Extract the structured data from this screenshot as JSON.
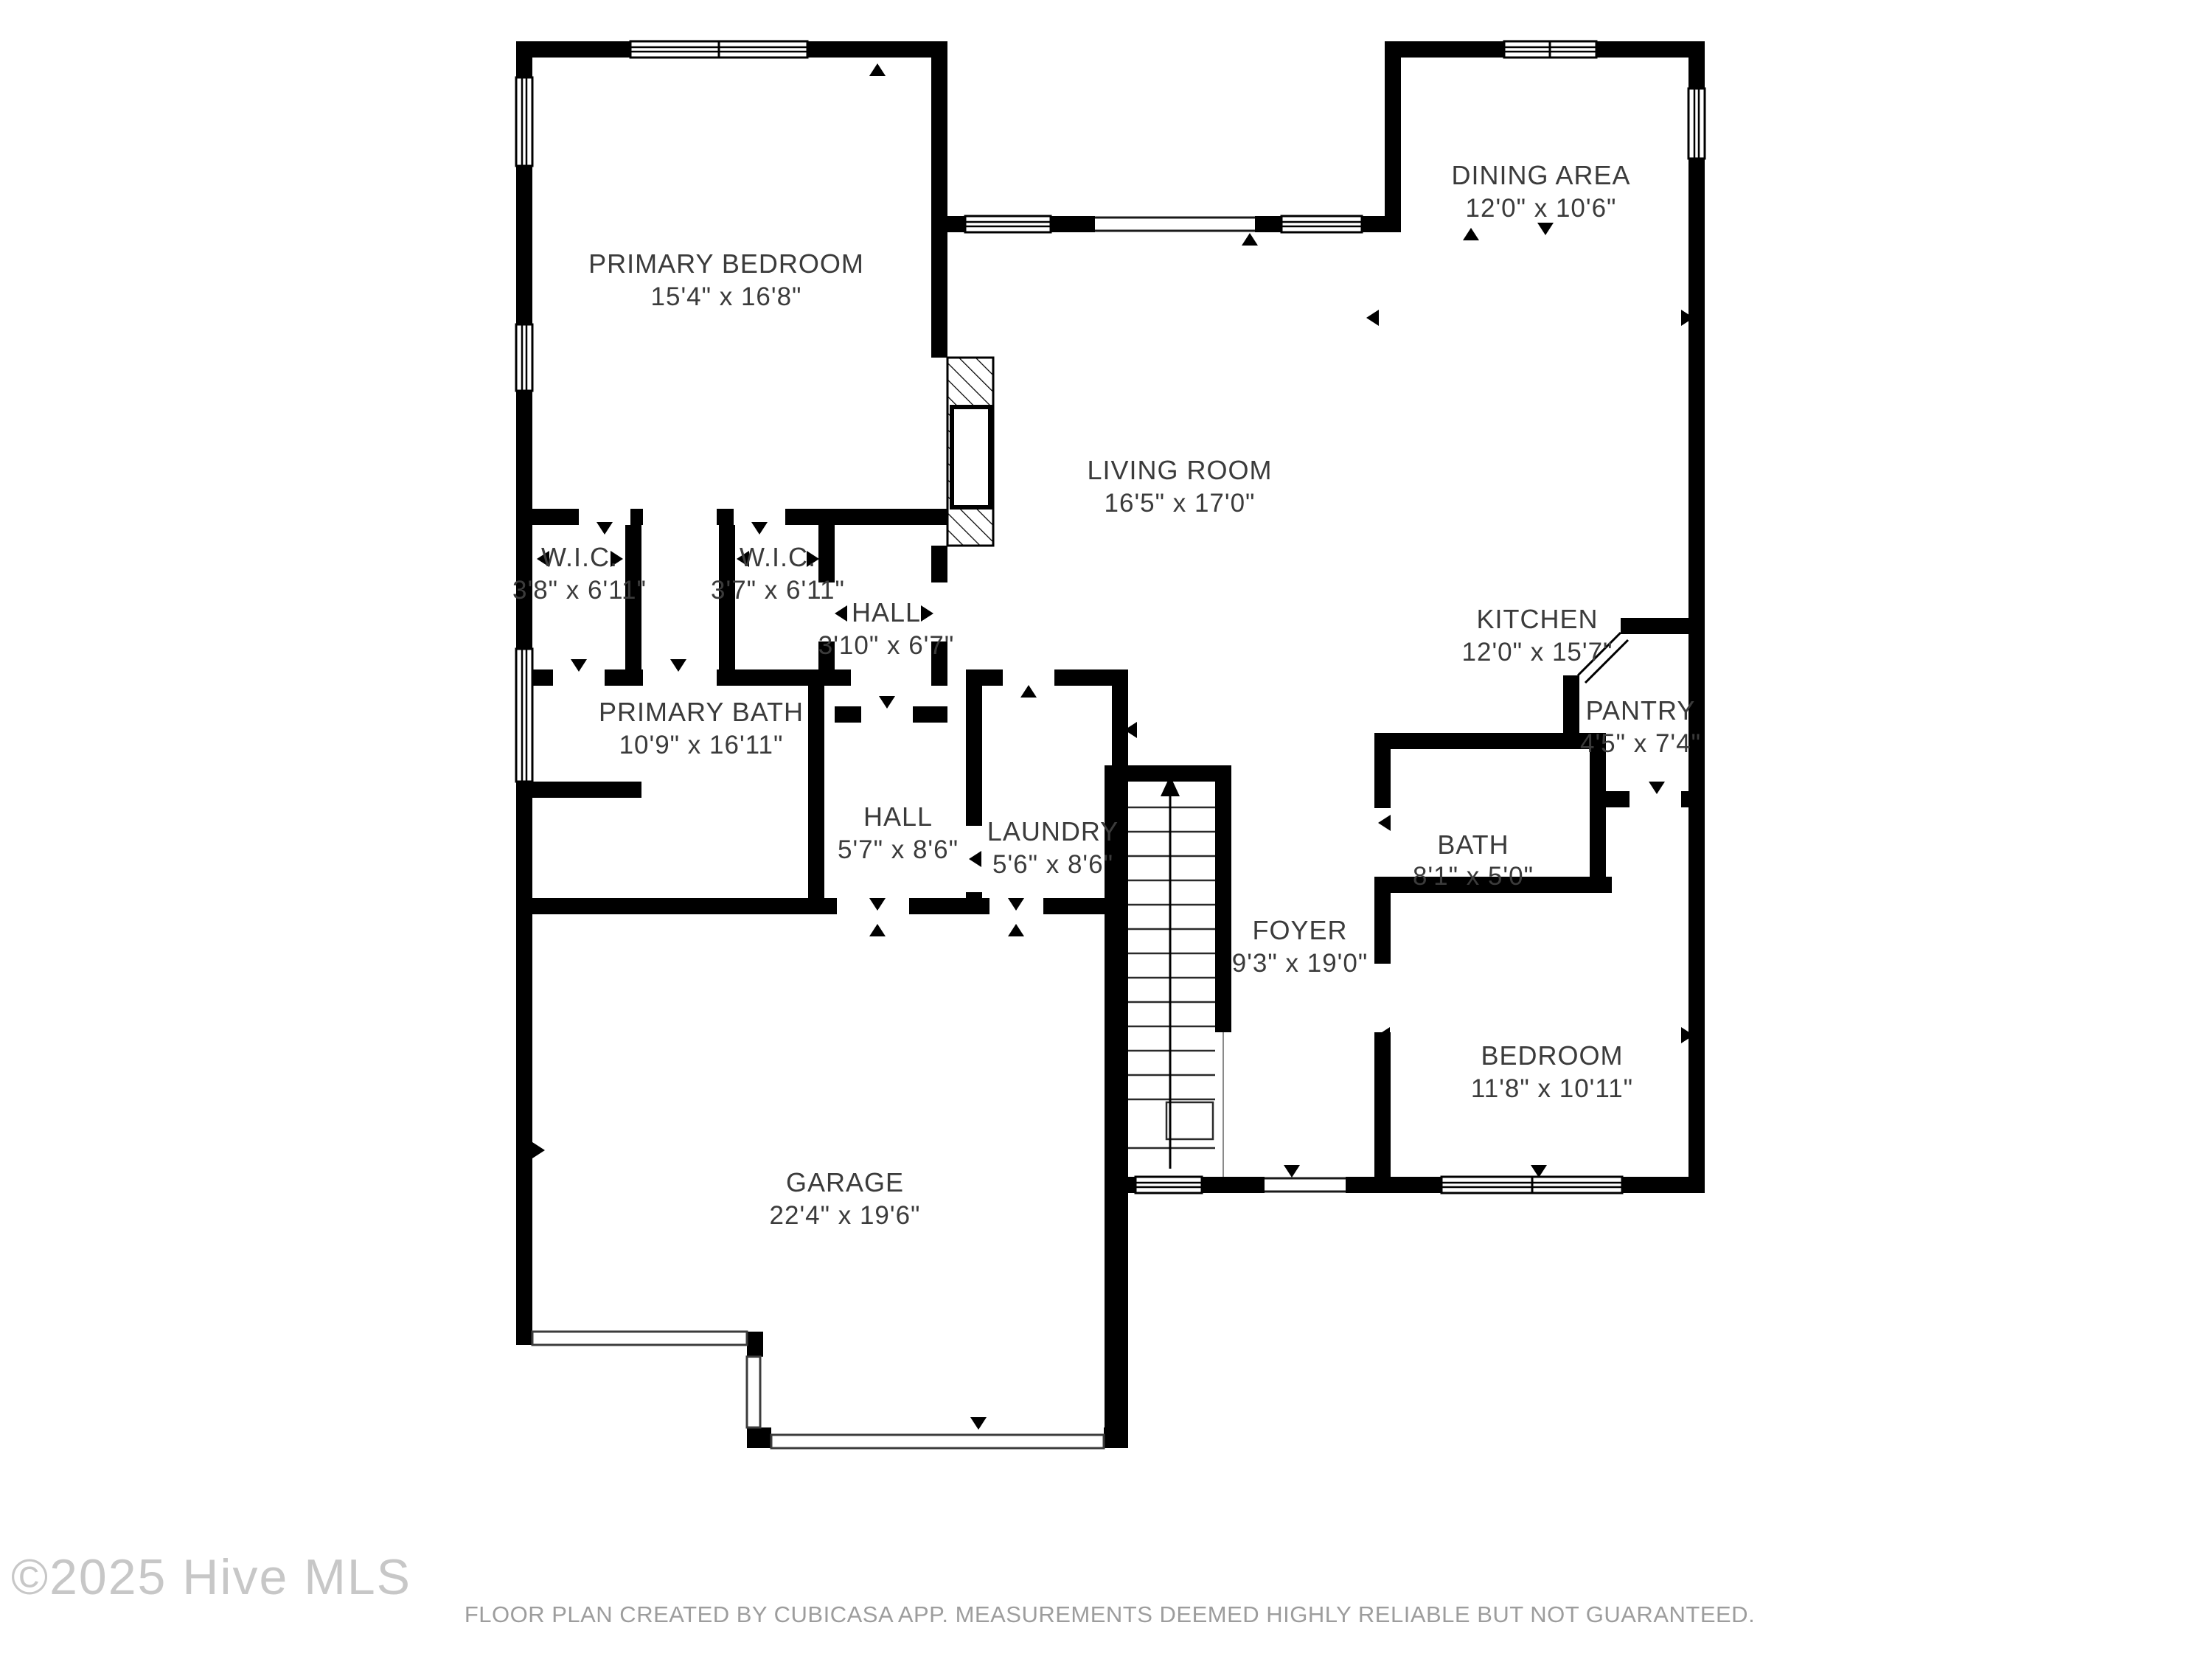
{
  "watermark": "©2025 Hive MLS",
  "footer": "FLOOR PLAN CREATED BY CUBICASA APP. MEASUREMENTS DEEMED HIGHLY RELIABLE BUT NOT GUARANTEED.",
  "stairs": {
    "direction": "up"
  },
  "colors": {
    "wall": "#000000",
    "label": "#3b3b3b",
    "watermark": "#c7c7c7",
    "footer": "#9d9d9d",
    "background": "#ffffff"
  },
  "rooms": [
    {
      "id": "primary-bedroom",
      "name": "PRIMARY BEDROOM",
      "dims": "15'4\" x 16'8\""
    },
    {
      "id": "dining-area",
      "name": "DINING AREA",
      "dims": "12'0\" x 10'6\""
    },
    {
      "id": "living-room",
      "name": "LIVING ROOM",
      "dims": "16'5\" x 17'0\""
    },
    {
      "id": "kitchen",
      "name": "KITCHEN",
      "dims": "12'0\" x 15'7\""
    },
    {
      "id": "wic-left",
      "name": "W.I.C.",
      "dims": "3'8\" x 6'11\""
    },
    {
      "id": "wic-right",
      "name": "W.I.C.",
      "dims": "3'7\" x 6'11\""
    },
    {
      "id": "hall-upper",
      "name": "HALL",
      "dims": "3'10\" x 6'7\""
    },
    {
      "id": "primary-bath",
      "name": "PRIMARY BATH",
      "dims": "10'9\" x 16'11\""
    },
    {
      "id": "hall-main",
      "name": "HALL",
      "dims": "5'7\" x 8'6\""
    },
    {
      "id": "laundry",
      "name": "LAUNDRY",
      "dims": "5'6\" x 8'6\""
    },
    {
      "id": "pantry",
      "name": "PANTRY",
      "dims": "4'5\" x 7'4\""
    },
    {
      "id": "bath",
      "name": "BATH",
      "dims": "8'1\" x 5'0\""
    },
    {
      "id": "foyer",
      "name": "FOYER",
      "dims": "9'3\" x 19'0\""
    },
    {
      "id": "bedroom",
      "name": "BEDROOM",
      "dims": "11'8\" x 10'11\""
    },
    {
      "id": "garage",
      "name": "GARAGE",
      "dims": "22'4\" x 19'6\""
    }
  ]
}
